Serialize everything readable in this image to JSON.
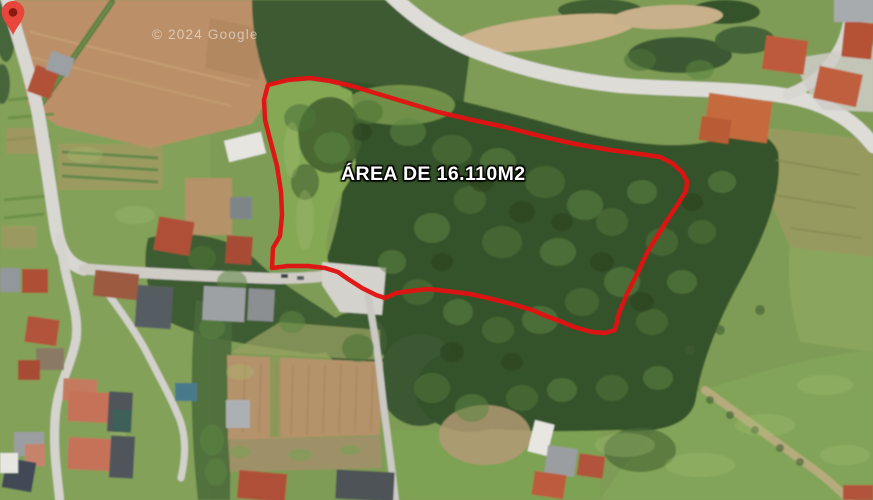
{
  "watermark": {
    "text": "© 2024 Google"
  },
  "overlay": {
    "area_label": {
      "text": "ÁREA DE 16.110M2",
      "text_color": "#ffffff",
      "outline_color": "#000000"
    },
    "polygon": {
      "points": "268,85 288,80 310,78 330,81 352,86 375,93 405,102 438,112 472,120 505,127 540,136 575,144 610,150 640,154 660,157 672,163 682,172 687,181 686,191 678,204 668,219 656,238 647,253 638,272 627,294 619,313 615,330 605,333 592,332 574,327 562,322 546,316 532,310 512,304 488,298 470,294 446,291 428,289 410,291 396,293 385,298 376,295 362,288 348,279 338,272 325,268 308,266 288,266 272,268 273,248 280,236 282,215 281,192 277,166 271,143 265,120 264,100",
      "color": "#e11313",
      "stroke_width": "4.5"
    },
    "marker": {
      "color": "#e8453b",
      "dot_color": "#8a1a10"
    }
  },
  "scene_palette": {
    "meadow_green": "#85a855",
    "forest_green": "#35522c",
    "field_tan": "#b9906a",
    "road_gray": "#dbd9d4",
    "roof_red": "#b5523a"
  }
}
